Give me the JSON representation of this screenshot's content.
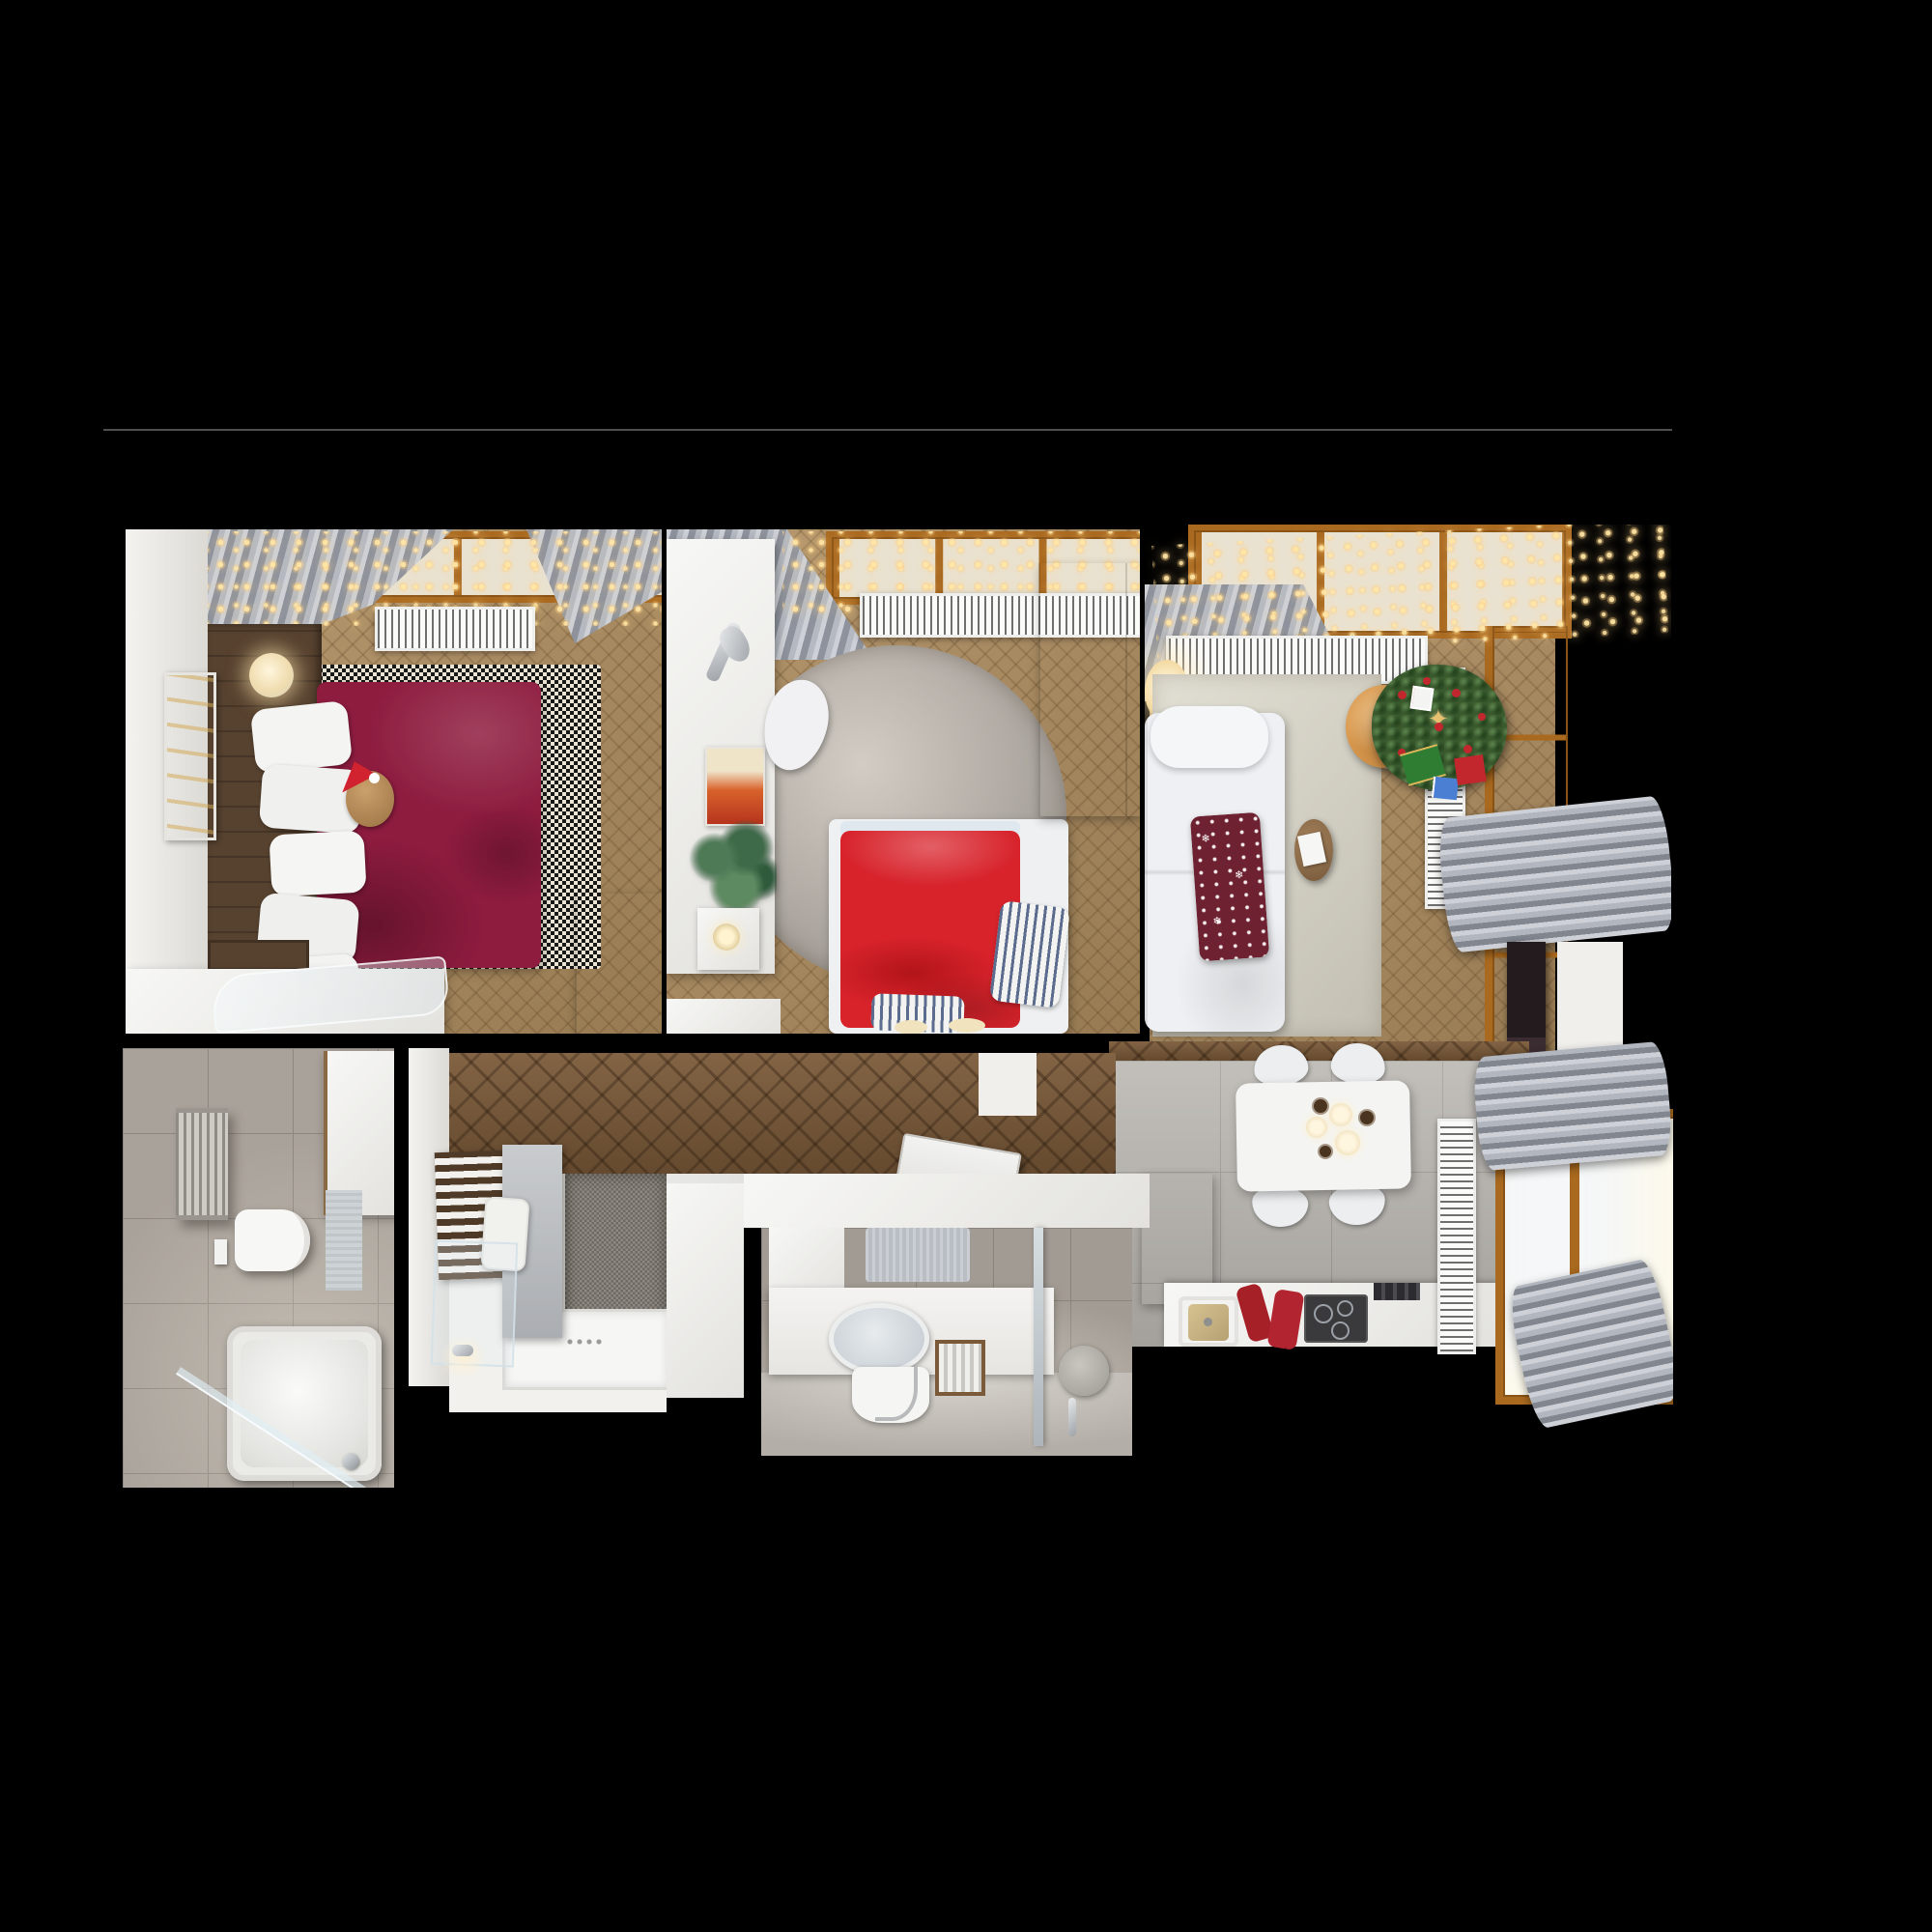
{
  "scene": {
    "kind": "apartment-floor-plan-3d-render-top-view",
    "background": "#000000"
  },
  "palette": {
    "divider_line": "#4f4f4f",
    "master_bed": "#8e1c3f",
    "kids_bed": "#d8232b",
    "pouf_orange": "#d9994e",
    "sofa_white": "#eef0f3",
    "rug_living_beige": "#d9d5c7",
    "rug_round_gray": "#b3aea7",
    "table_white": "#f4f4f2",
    "tv_dark": "#241b1e",
    "tree_green": "#3a5a2e",
    "throw_burgundy": "#6e2130",
    "headboard_wood": "#57422f",
    "string_light": "#ffd78f"
  },
  "decor": {
    "snowflake_glyph": "❄",
    "star_glyph": "✦"
  },
  "rooms": {
    "master_bedroom": {
      "name": "master-bedroom",
      "objects": [
        "double-bed-burgundy",
        "white-pillows",
        "teddy-bear-santa-hat",
        "checkered-rug",
        "headboard-wood-panel",
        "round-wall-sconces",
        "wall-artwork",
        "gray-curtains",
        "string-lights",
        "radiator",
        "window",
        "white-dresser",
        "acrylic-chaise",
        "wardrobe"
      ]
    },
    "kids_bedroom": {
      "name": "kids-bedroom",
      "objects": [
        "single-bed-red",
        "striped-pillows",
        "slippers",
        "round-gray-rug",
        "white-desk",
        "desk-lamp",
        "fox-poster",
        "plant",
        "candle-drawer",
        "desk-chair",
        "gray-curtain",
        "string-lights",
        "radiator",
        "window",
        "tall-cabinet"
      ]
    },
    "living_room": {
      "name": "living-room",
      "objects": [
        "corner-sofa-white",
        "nordic-throw",
        "coffee-table-book",
        "orange-pouf",
        "christmas-tree",
        "gift-boxes",
        "glowing-sphere-lamp",
        "beige-rug",
        "gray-curtains",
        "string-lights",
        "radiators",
        "windows",
        "tv-panel"
      ]
    },
    "kitchen_dining": {
      "name": "kitchen-dining",
      "objects": [
        "dining-table",
        "four-chairs",
        "candle-centerpiece",
        "kitchen-counter",
        "sink",
        "cooktop",
        "red-oven-mitts",
        "tall-cabinets",
        "vertical-radiator",
        "window",
        "gray-curtains"
      ]
    },
    "bathroom_main": {
      "name": "bathroom-with-tub",
      "objects": [
        "bathtub",
        "glass-screen",
        "wall-hung-toilet",
        "towel-radiator",
        "white-cabinet",
        "bath-mat",
        "stone-tiles"
      ]
    },
    "shower_room": {
      "name": "shower-room",
      "objects": [
        "shower-tray",
        "glass-door",
        "mosaic-wall",
        "wood-slat-accent",
        "towel",
        "faucet"
      ]
    },
    "bathroom_second": {
      "name": "second-bathroom",
      "objects": [
        "vanity",
        "oval-mirror",
        "pedestal-sink",
        "framed-towel-radiator",
        "glass-shower",
        "round-mirror",
        "open-door"
      ]
    },
    "hallway": {
      "name": "hallway",
      "objects": [
        "dark-herringbone-floor",
        "white-walls",
        "built-in-slab"
      ]
    }
  }
}
